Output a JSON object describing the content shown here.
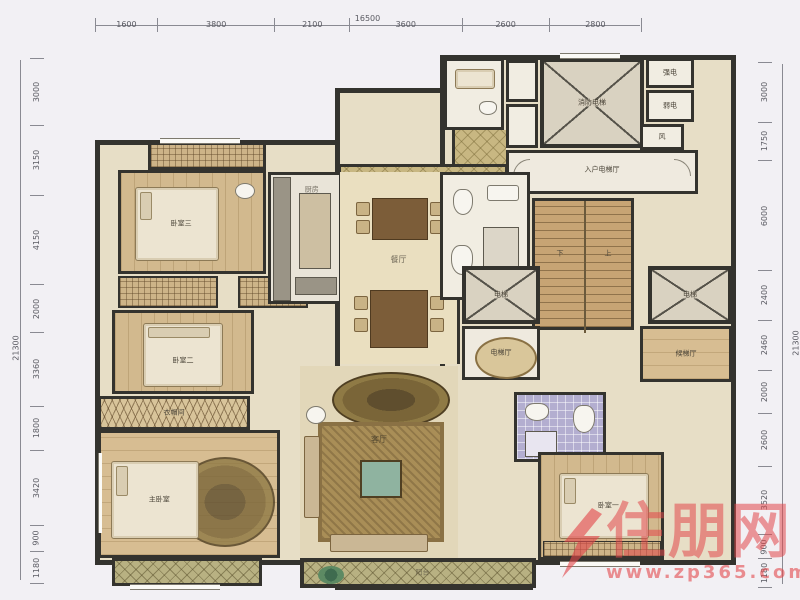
{
  "dims": {
    "top": {
      "total": "16500",
      "segments": [
        "1600",
        "3800",
        "2100",
        "3600",
        "2600",
        "2800"
      ]
    },
    "left": {
      "total": "21300",
      "segments": [
        "3000",
        "3150",
        "4150",
        "2000",
        "3360",
        "1800",
        "3420",
        "900",
        "1180"
      ]
    },
    "right": {
      "total": "21300",
      "segments": [
        "3000",
        "1750",
        "6000",
        "2400",
        "2460",
        "2000",
        "2600",
        "3520",
        "900",
        "1180"
      ]
    }
  },
  "rooms": {
    "bedroom3": "卧室三",
    "bedroom2": "卧室二",
    "master_bedroom": "主卧室",
    "cloakroom": "衣帽间",
    "kitchen": "厨房",
    "dining": "餐厅",
    "foyer": "玄关",
    "living": "客厅",
    "bedroom1": "卧室一",
    "balcony": "阳台",
    "fire_elevator": "消防电梯",
    "elevator_hall": "入户电梯厅",
    "elevator_left": "电梯",
    "elevator_right": "电梯",
    "elevator_lobby": "电梯厅",
    "waiting_hall": "候梯厅",
    "strong_electric": "强电",
    "weak_electric": "弱电",
    "vent": "风",
    "stair_up": "上",
    "stair_down": "下"
  },
  "watermark": {
    "name": "住朋网",
    "url": "www.zp365.com",
    "color": "#e2474b"
  }
}
